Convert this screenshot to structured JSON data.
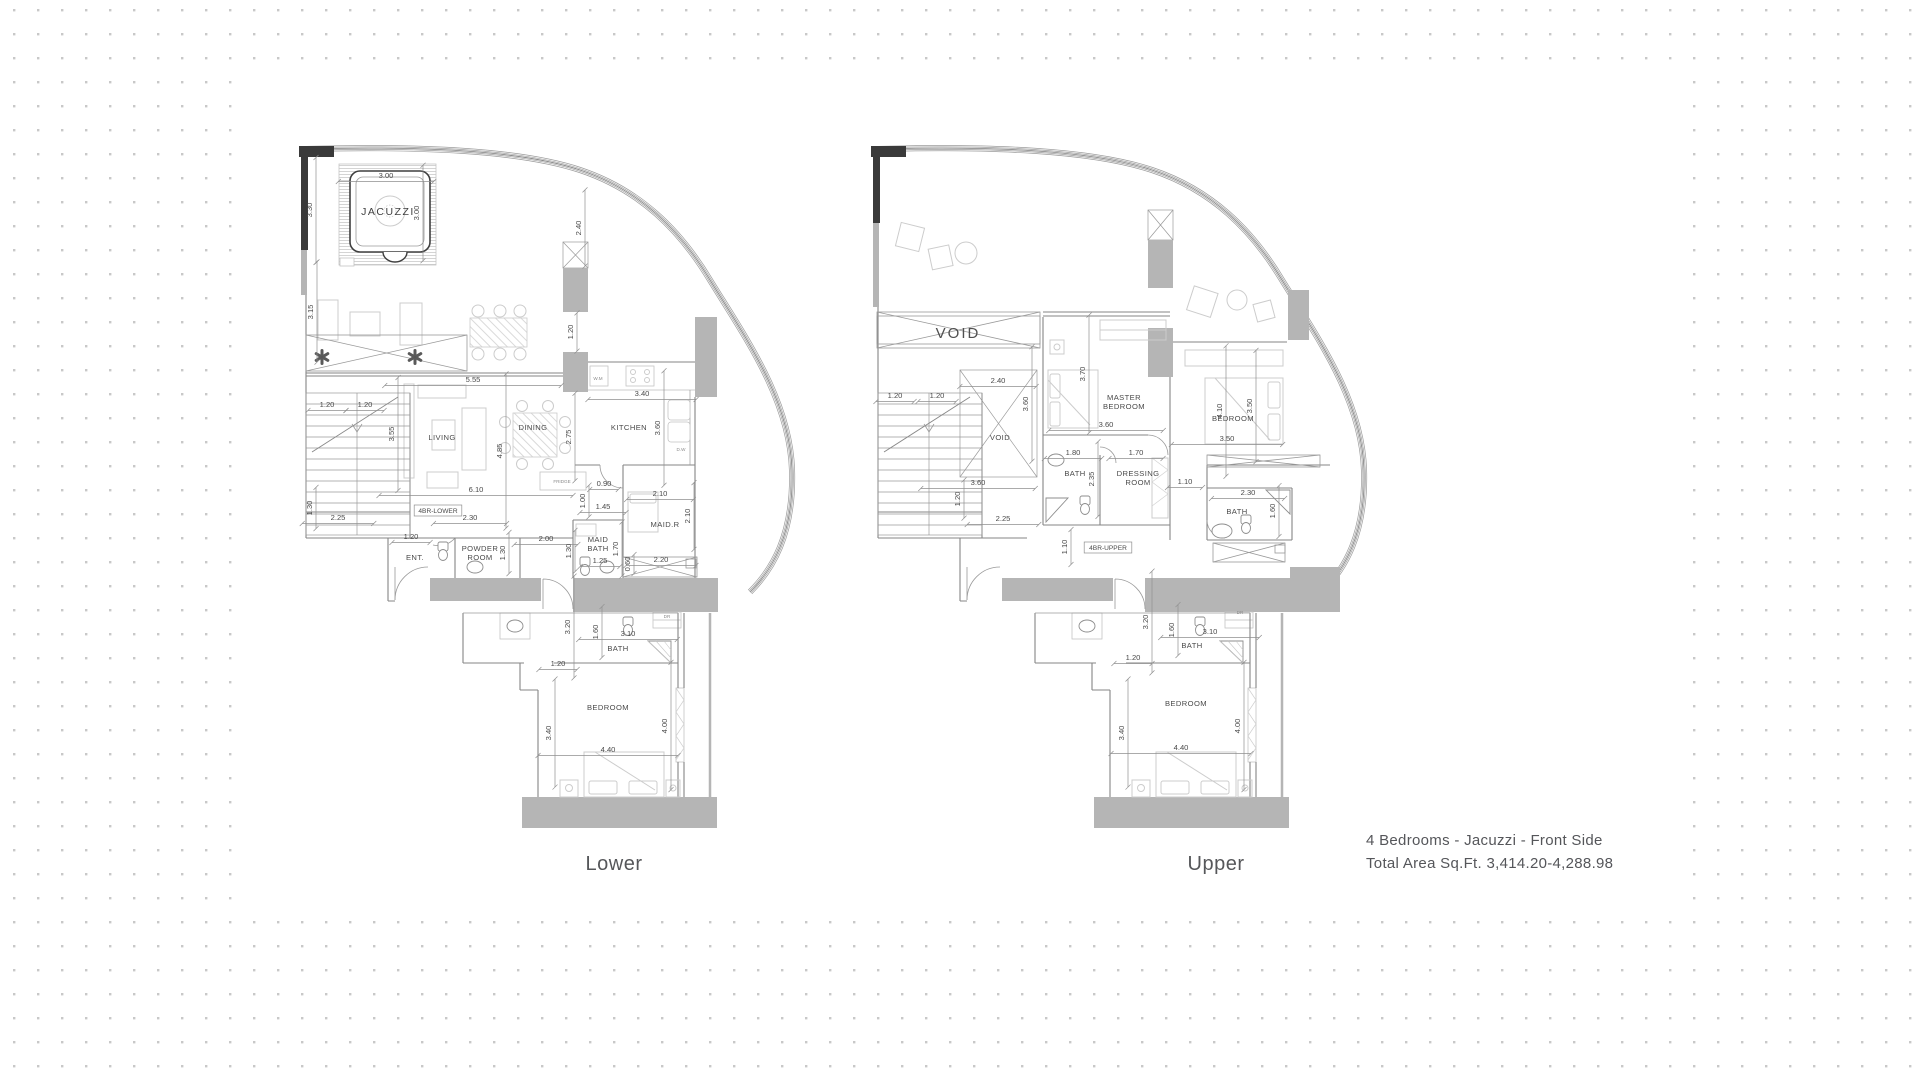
{
  "title": "4 Bedrooms - Jacuzzi - Front Side floor plans",
  "caption": {
    "line1": "4 Bedrooms - Jacuzzi - Front Side",
    "line2": "Total Area Sq.Ft.  3,414.20-4,288.98"
  },
  "colors": {
    "slab_gray": "#b5b5b5",
    "wall_line": "#868686",
    "text": "#4a4a4a",
    "dot_grid": "#c8c8c8"
  },
  "plans": [
    {
      "id": "lower",
      "name": "Lower",
      "labels": [
        {
          "t": "JACUZZI",
          "x": 388,
          "y": 215,
          "k": "big",
          "n": "room-jacuzzi"
        },
        {
          "t": "3.00",
          "x": 386,
          "y": 178,
          "k": "dim"
        },
        {
          "t": "3.00",
          "x": 419,
          "y": 213,
          "k": "dimv"
        },
        {
          "t": "3.30",
          "x": 312,
          "y": 210,
          "k": "dimv"
        },
        {
          "t": "3.15",
          "x": 313,
          "y": 312,
          "k": "dimv"
        },
        {
          "t": "2.40",
          "x": 581,
          "y": 228,
          "k": "dimv"
        },
        {
          "t": "1.20",
          "x": 573,
          "y": 332,
          "k": "dimv"
        },
        {
          "t": "5.55",
          "x": 473,
          "y": 382,
          "k": "dim"
        },
        {
          "t": "1.20",
          "x": 327,
          "y": 407,
          "k": "dim"
        },
        {
          "t": "1.20",
          "x": 365,
          "y": 407,
          "k": "dim"
        },
        {
          "t": "3.55",
          "x": 394,
          "y": 434,
          "k": "dimv"
        },
        {
          "t": "LIVING",
          "x": 442,
          "y": 440,
          "k": "room",
          "n": "room-living"
        },
        {
          "t": "DINING",
          "x": 533,
          "y": 430,
          "k": "room",
          "n": "room-dining"
        },
        {
          "t": "4.85",
          "x": 502,
          "y": 451,
          "k": "dimv"
        },
        {
          "t": "2.75",
          "x": 571,
          "y": 437,
          "k": "dimv"
        },
        {
          "t": "KITCHEN",
          "x": 629,
          "y": 430,
          "k": "room",
          "n": "room-kitchen"
        },
        {
          "t": "3.40",
          "x": 642,
          "y": 396,
          "k": "dim"
        },
        {
          "t": "3.60",
          "x": 660,
          "y": 428,
          "k": "dimv"
        },
        {
          "t": "W.M",
          "x": 598,
          "y": 380,
          "k": "tiny"
        },
        {
          "t": "D.W",
          "x": 681,
          "y": 451,
          "k": "tiny"
        },
        {
          "t": "FRIDGE",
          "x": 562,
          "y": 483,
          "k": "tiny"
        },
        {
          "t": "6.10",
          "x": 476,
          "y": 492,
          "k": "dim"
        },
        {
          "t": "4BR-LOWER",
          "x": 438,
          "y": 513,
          "k": "box",
          "n": "unit-tag"
        },
        {
          "t": "2.30",
          "x": 470,
          "y": 520,
          "k": "dim"
        },
        {
          "t": "1.30",
          "x": 312,
          "y": 508,
          "k": "dimv"
        },
        {
          "t": "2.25",
          "x": 338,
          "y": 520,
          "k": "dim"
        },
        {
          "t": "0.90",
          "x": 604,
          "y": 486,
          "k": "dim"
        },
        {
          "t": "1.00",
          "x": 585,
          "y": 501,
          "k": "dimv"
        },
        {
          "t": "1.45",
          "x": 603,
          "y": 509,
          "k": "dim"
        },
        {
          "t": "2.10",
          "x": 660,
          "y": 496,
          "k": "dim"
        },
        {
          "t": "MAID.R",
          "x": 665,
          "y": 527,
          "k": "room",
          "n": "room-maid"
        },
        {
          "t": "2.10",
          "x": 690,
          "y": 516,
          "k": "dimv"
        },
        {
          "t": "1.20",
          "x": 411,
          "y": 539,
          "k": "dim"
        },
        {
          "t": "ENT.",
          "x": 415,
          "y": 560,
          "k": "room",
          "n": "room-entrance"
        },
        {
          "t": "POWDER\nROOM",
          "x": 480,
          "y": 551,
          "k": "room",
          "n": "room-powder"
        },
        {
          "t": "1.30",
          "x": 505,
          "y": 553,
          "k": "dimv"
        },
        {
          "t": "2.00",
          "x": 546,
          "y": 541,
          "k": "dim"
        },
        {
          "t": "1.30",
          "x": 571,
          "y": 551,
          "k": "dimv"
        },
        {
          "t": "MAID\nBATH",
          "x": 598,
          "y": 542,
          "k": "room",
          "n": "room-maid-bath"
        },
        {
          "t": "1.25",
          "x": 600,
          "y": 563,
          "k": "dim"
        },
        {
          "t": "1.70",
          "x": 618,
          "y": 549,
          "k": "dimv"
        },
        {
          "t": "0.60",
          "x": 630,
          "y": 564,
          "k": "dimv"
        },
        {
          "t": "2.20",
          "x": 661,
          "y": 562,
          "k": "dim"
        },
        {
          "t": "DR",
          "x": 667,
          "y": 618,
          "k": "tiny"
        },
        {
          "t": "3.20",
          "x": 570,
          "y": 627,
          "k": "dimv"
        },
        {
          "t": "1.60",
          "x": 598,
          "y": 632,
          "k": "dimv"
        },
        {
          "t": "3.10",
          "x": 628,
          "y": 636,
          "k": "dim"
        },
        {
          "t": "BATH",
          "x": 618,
          "y": 651,
          "k": "room",
          "n": "room-bath"
        },
        {
          "t": "1.20",
          "x": 558,
          "y": 666,
          "k": "dim"
        },
        {
          "t": "BEDROOM",
          "x": 608,
          "y": 710,
          "k": "room",
          "n": "room-bedroom"
        },
        {
          "t": "3.40",
          "x": 551,
          "y": 733,
          "k": "dimv"
        },
        {
          "t": "4.40",
          "x": 608,
          "y": 752,
          "k": "dim"
        },
        {
          "t": "4.00",
          "x": 667,
          "y": 726,
          "k": "dimv"
        }
      ]
    },
    {
      "id": "upper",
      "name": "Upper",
      "labels": [
        {
          "t": "VOID",
          "x": 958,
          "y": 338,
          "k": "void",
          "n": "void-terrace"
        },
        {
          "t": "2.40",
          "x": 998,
          "y": 383,
          "k": "dim"
        },
        {
          "t": "1.20",
          "x": 895,
          "y": 398,
          "k": "dim"
        },
        {
          "t": "1.20",
          "x": 937,
          "y": 398,
          "k": "dim"
        },
        {
          "t": "3.60",
          "x": 1028,
          "y": 404,
          "k": "dimv"
        },
        {
          "t": "VOID",
          "x": 1000,
          "y": 440,
          "k": "room",
          "n": "void-stair"
        },
        {
          "t": "3.70",
          "x": 1085,
          "y": 374,
          "k": "dimv"
        },
        {
          "t": "MASTER\nBEDROOM",
          "x": 1124,
          "y": 400,
          "k": "room",
          "n": "room-master-bedroom"
        },
        {
          "t": "3.60",
          "x": 1106,
          "y": 427,
          "k": "dim"
        },
        {
          "t": "4.10",
          "x": 1222,
          "y": 411,
          "k": "dimv"
        },
        {
          "t": "BEDROOM",
          "x": 1233,
          "y": 421,
          "k": "room",
          "n": "room-bedroom2"
        },
        {
          "t": "3.50",
          "x": 1252,
          "y": 406,
          "k": "dimv"
        },
        {
          "t": "3.50",
          "x": 1227,
          "y": 441,
          "k": "dim"
        },
        {
          "t": "1.80",
          "x": 1073,
          "y": 455,
          "k": "dim"
        },
        {
          "t": "BATH",
          "x": 1075,
          "y": 476,
          "k": "room",
          "n": "room-master-bath"
        },
        {
          "t": "2.35",
          "x": 1094,
          "y": 479,
          "k": "dimv"
        },
        {
          "t": "1.70",
          "x": 1136,
          "y": 455,
          "k": "dim"
        },
        {
          "t": "DRESSING\nROOM",
          "x": 1138,
          "y": 476,
          "k": "room",
          "n": "room-dressing"
        },
        {
          "t": "1.10",
          "x": 1185,
          "y": 484,
          "k": "dim"
        },
        {
          "t": "2.30",
          "x": 1248,
          "y": 495,
          "k": "dim"
        },
        {
          "t": "BATH",
          "x": 1237,
          "y": 514,
          "k": "room",
          "n": "room-bath2"
        },
        {
          "t": "1.60",
          "x": 1275,
          "y": 511,
          "k": "dimv"
        },
        {
          "t": "3.60",
          "x": 978,
          "y": 485,
          "k": "dim"
        },
        {
          "t": "1.20",
          "x": 960,
          "y": 499,
          "k": "dimv"
        },
        {
          "t": "2.25",
          "x": 1003,
          "y": 521,
          "k": "dim"
        },
        {
          "t": "1.10",
          "x": 1067,
          "y": 547,
          "k": "dimv"
        },
        {
          "t": "4BR-UPPER",
          "x": 1108,
          "y": 550,
          "k": "box",
          "n": "unit-tag"
        },
        {
          "t": "DR",
          "x": 1240,
          "y": 614,
          "k": "tiny"
        },
        {
          "t": "3.20",
          "x": 1148,
          "y": 622,
          "k": "dimv"
        },
        {
          "t": "1.60",
          "x": 1174,
          "y": 630,
          "k": "dimv"
        },
        {
          "t": "3.10",
          "x": 1210,
          "y": 634,
          "k": "dim"
        },
        {
          "t": "BATH",
          "x": 1192,
          "y": 648,
          "k": "room",
          "n": "room-bath3"
        },
        {
          "t": "1.20",
          "x": 1133,
          "y": 660,
          "k": "dim"
        },
        {
          "t": "BEDROOM",
          "x": 1186,
          "y": 706,
          "k": "room",
          "n": "room-bedroom3"
        },
        {
          "t": "3.40",
          "x": 1124,
          "y": 733,
          "k": "dimv"
        },
        {
          "t": "4.40",
          "x": 1181,
          "y": 750,
          "k": "dim"
        },
        {
          "t": "4.00",
          "x": 1240,
          "y": 726,
          "k": "dimv"
        }
      ]
    }
  ]
}
